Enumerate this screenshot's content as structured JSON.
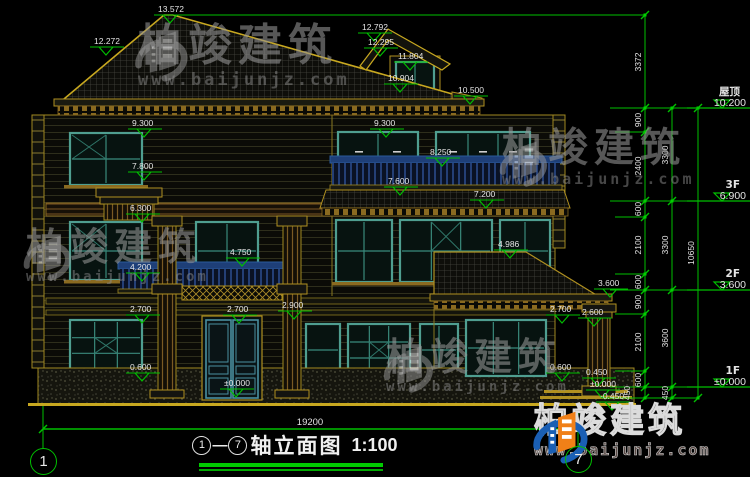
{
  "title_bar": {
    "start_axis": "1",
    "dash": "—",
    "end_axis": "7",
    "name": "轴立面图",
    "scale": "1:100"
  },
  "overall_dim": "19200",
  "axis_bubbles": {
    "left": "1",
    "right": "7"
  },
  "levels": [
    {
      "label": "屋顶",
      "value": "10.200",
      "y": 108
    },
    {
      "label": "3F",
      "value": "6.900",
      "y": 201
    },
    {
      "label": "2F",
      "value": "3.600",
      "y": 290
    },
    {
      "label": "1F",
      "value": "±0.000",
      "y": 387
    }
  ],
  "dim_columns": {
    "col1": {
      "x": 645,
      "top": 15,
      "bottom": 398,
      "labels": [
        {
          "v": "3372",
          "y": 62
        },
        {
          "v": "900",
          "y": 120
        },
        {
          "v": "2400",
          "y": 166
        },
        {
          "v": "600",
          "y": 209
        },
        {
          "v": "2100",
          "y": 245
        },
        {
          "v": "600",
          "y": 282
        },
        {
          "v": "900",
          "y": 302
        },
        {
          "v": "2100",
          "y": 342
        },
        {
          "v": "600",
          "y": 380
        },
        {
          "v": "450",
          "y": 393,
          "dx": -11
        }
      ],
      "ticks": [
        15,
        108,
        132,
        201,
        217,
        274,
        290,
        314,
        371,
        387,
        398
      ]
    },
    "col2": {
      "x": 672,
      "top": 108,
      "bottom": 398,
      "labels": [
        {
          "v": "3300",
          "y": 155
        },
        {
          "v": "3300",
          "y": 245
        },
        {
          "v": "3600",
          "y": 338
        },
        {
          "v": "450",
          "y": 393
        }
      ],
      "ticks": [
        108,
        201,
        290,
        387,
        398
      ]
    },
    "col3": {
      "x": 698,
      "top": 108,
      "bottom": 398,
      "labels": [
        {
          "v": "10650",
          "y": 253
        }
      ],
      "ticks": [
        108,
        398
      ]
    }
  },
  "ext_lines": [
    [
      175,
      15,
      645
    ],
    [
      610,
      108,
      698
    ],
    [
      615,
      132,
      645
    ],
    [
      610,
      201,
      698
    ],
    [
      615,
      217,
      645
    ],
    [
      615,
      274,
      645
    ],
    [
      610,
      290,
      698
    ],
    [
      615,
      314,
      645
    ],
    [
      615,
      371,
      645
    ],
    [
      610,
      387,
      698
    ],
    [
      603,
      398,
      698
    ]
  ],
  "elevation_markers": [
    {
      "v": "13.572",
      "x": 158,
      "y": 4
    },
    {
      "v": "12.272",
      "x": 94,
      "y": 36
    },
    {
      "v": "12.792",
      "x": 362,
      "y": 22
    },
    {
      "v": "12.295",
      "x": 368,
      "y": 37
    },
    {
      "v": "11.804",
      "x": 398,
      "y": 51
    },
    {
      "v": "10.904",
      "x": 388,
      "y": 73
    },
    {
      "v": "10.500",
      "x": 458,
      "y": 85
    },
    {
      "v": "9.300",
      "x": 132,
      "y": 118
    },
    {
      "v": "9.300",
      "x": 374,
      "y": 118
    },
    {
      "v": "8.250",
      "x": 430,
      "y": 147
    },
    {
      "v": "7.800",
      "x": 132,
      "y": 161
    },
    {
      "v": "7.600",
      "x": 388,
      "y": 176
    },
    {
      "v": "7.200",
      "x": 474,
      "y": 189
    },
    {
      "v": "6.300",
      "x": 130,
      "y": 203
    },
    {
      "v": "4.986",
      "x": 498,
      "y": 239
    },
    {
      "v": "4.750",
      "x": 230,
      "y": 247
    },
    {
      "v": "4.200",
      "x": 130,
      "y": 262
    },
    {
      "v": "3.600",
      "x": 598,
      "y": 278
    },
    {
      "v": "2.900",
      "x": 282,
      "y": 300
    },
    {
      "v": "2.700",
      "x": 130,
      "y": 304
    },
    {
      "v": "2.700",
      "x": 227,
      "y": 304
    },
    {
      "v": "2.700",
      "x": 550,
      "y": 304
    },
    {
      "v": "2.600",
      "x": 582,
      "y": 307
    },
    {
      "v": "0.600",
      "x": 130,
      "y": 362
    },
    {
      "v": "0.600",
      "x": 550,
      "y": 362
    },
    {
      "v": "±0.000",
      "x": 224,
      "y": 378
    },
    {
      "v": "0.450",
      "x": 586,
      "y": 367
    },
    {
      "v": "±0.000",
      "x": 590,
      "y": 379
    },
    {
      "v": "-0.450",
      "x": 600,
      "y": 391
    }
  ],
  "watermark": {
    "brand": "柏竣建筑",
    "url": "www.baijunjz.com"
  },
  "logo": {
    "brand": "柏竣建筑",
    "url": "www.baijunjz.com"
  },
  "colors": {
    "cad_yellow": "#c8a820",
    "cad_green": "#00c000",
    "window_teal": "#4f9e90",
    "railing_blue": "#1e3f78",
    "text_white": "#e4e4e4"
  }
}
